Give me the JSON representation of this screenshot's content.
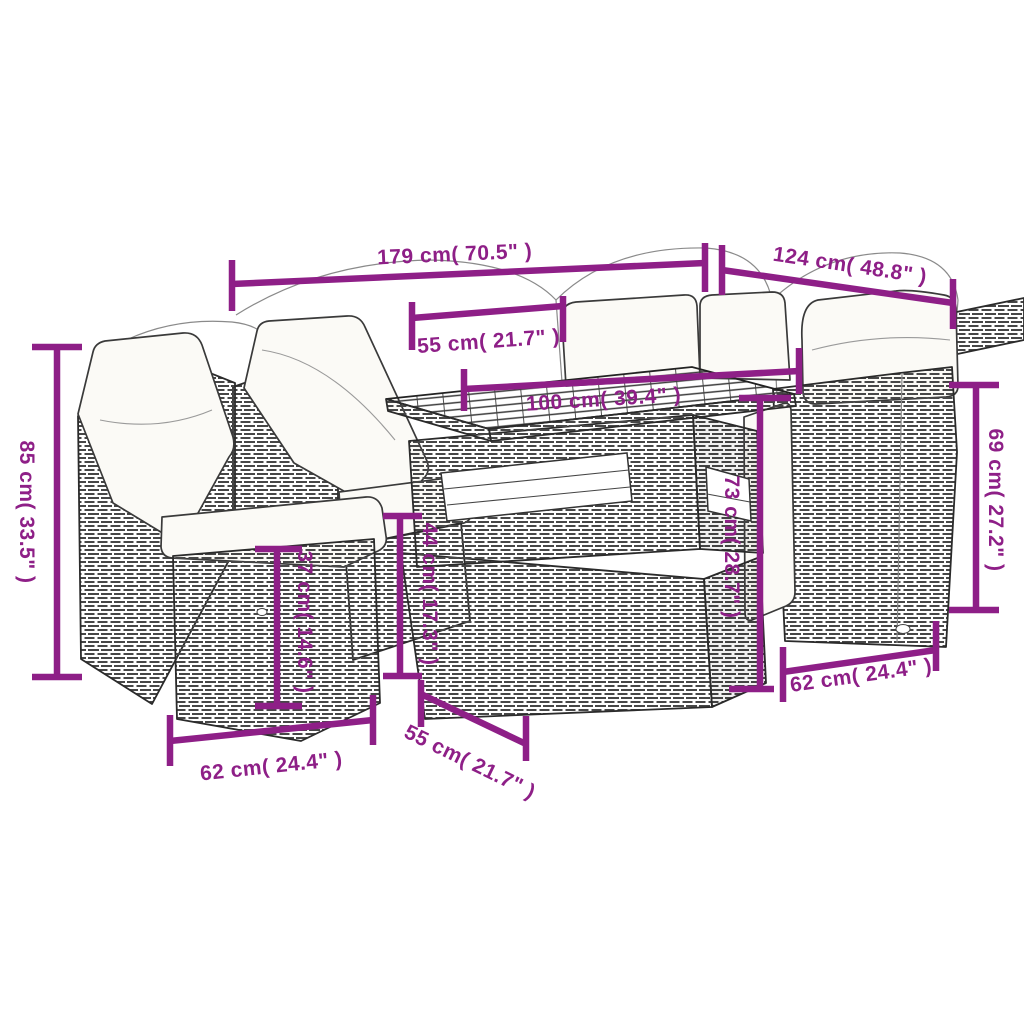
{
  "figure": {
    "kind": "product dimension line drawing",
    "subject": "poly rattan garden lounge set with cushions and cube dining table"
  },
  "colors": {
    "dimension_accent": "#8E1F87",
    "sketch_line": "#2B2B2B",
    "cushion_fill": "#FBFAF6",
    "background": "#FFFFFF"
  },
  "dimensions": [
    {
      "id": "total-width",
      "cm": 179,
      "inches": 70.5,
      "label": "179 cm( 70.5\" )"
    },
    {
      "id": "total-depth",
      "cm": 124,
      "inches": 48.8,
      "label": "124 cm( 48.8\" )"
    },
    {
      "id": "seat-width-top",
      "cm": 55,
      "inches": 21.7,
      "label": "55 cm( 21.7\" )"
    },
    {
      "id": "table-length",
      "cm": 100,
      "inches": 39.4,
      "label": "100 cm( 39.4\" )"
    },
    {
      "id": "back-height",
      "cm": 85,
      "inches": 33.5,
      "label": "85 cm( 33.5\" )"
    },
    {
      "id": "side-height",
      "cm": 69,
      "inches": 27.2,
      "label": "69 cm( 27.2\" )"
    },
    {
      "id": "seat-height",
      "cm": 37,
      "inches": 14.6,
      "label": "37 cm( 14.6\" )"
    },
    {
      "id": "bench-height",
      "cm": 44,
      "inches": 17.3,
      "label": "44 cm( 17.3\" )"
    },
    {
      "id": "table-height",
      "cm": 73,
      "inches": 28.7,
      "label": "73 cm( 28.7\" )"
    },
    {
      "id": "seat-width-left",
      "cm": 62,
      "inches": 24.4,
      "label": "62 cm( 24.4\" )"
    },
    {
      "id": "table-depth-bottom",
      "cm": 55,
      "inches": 21.7,
      "label": "55 cm( 21.7\" )"
    },
    {
      "id": "seat-width-right",
      "cm": 62,
      "inches": 24.4,
      "label": "62 cm( 24.4\" )"
    }
  ]
}
